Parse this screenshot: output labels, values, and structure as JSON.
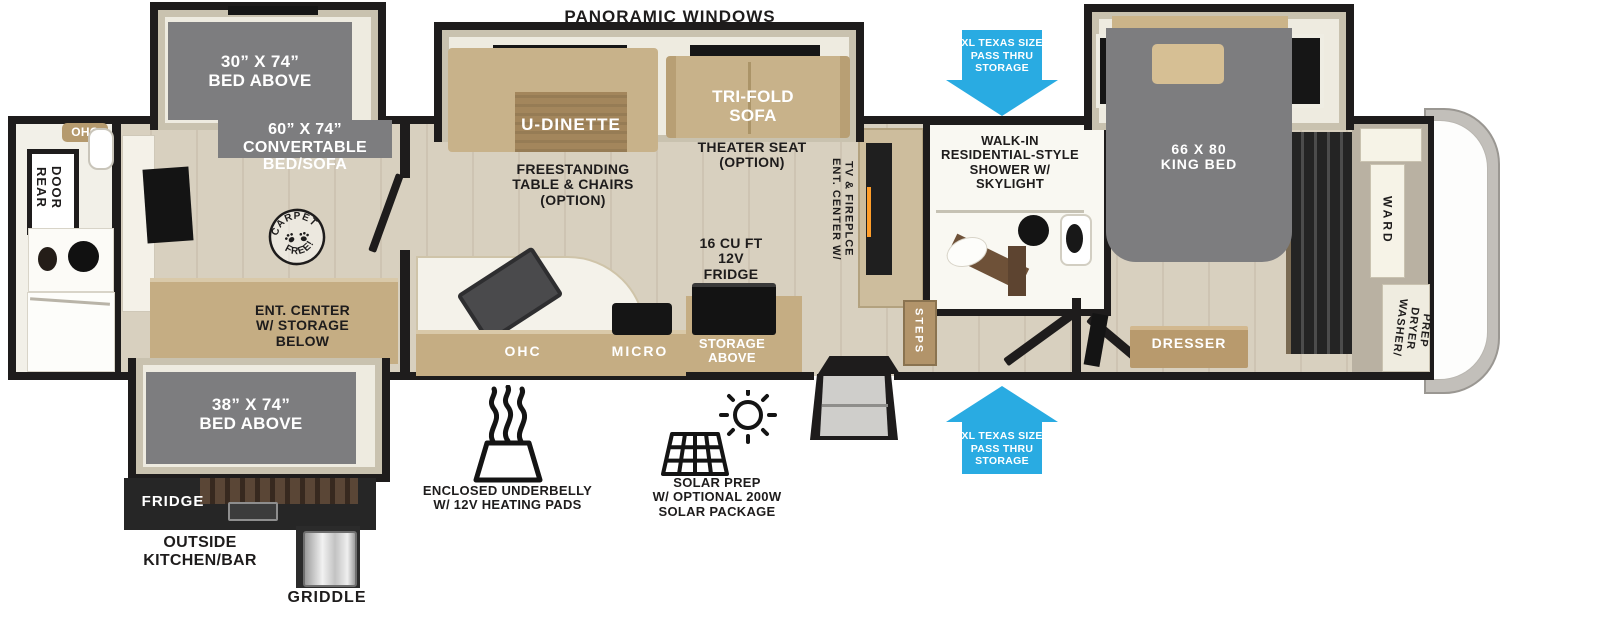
{
  "plan": {
    "type": "rv-floorplan",
    "colors": {
      "arrow_blue": "#29abe2",
      "bed_gray": "#7d7d7f",
      "wall_black": "#1e1c1c",
      "floor_wood": "#d8d0bf",
      "cabinet_tan": "#c5ad83",
      "slide_beige": "#eeebe0"
    }
  },
  "exterior": {
    "panoramic_windows": "PANORAMIC WINDOWS",
    "pass_thru_top": "XL TEXAS SIZE\nPASS THRU\nSTORAGE",
    "pass_thru_bottom": "XL TEXAS SIZE\nPASS THRU\nSTORAGE",
    "outside_kitchen": "OUTSIDE\nKITCHEN/BAR",
    "outside_fridge": "FRIDGE",
    "griddle": "GRIDDLE",
    "underbelly": "ENCLOSED UNDERBELLY\nW/ 12V HEATING PADS",
    "solar": "SOLAR PREP\nW/ OPTIONAL 200W\nSOLAR PACKAGE"
  },
  "rear_bath": {
    "ohc": "OHC",
    "rear_door": "REAR\nDOOR"
  },
  "bunk_room": {
    "bed_above_top": "30” X 74”\nBED ABOVE",
    "convertible": "60” X 74”\nCONVERTABLE\nBED/SOFA",
    "bed_above_bottom": "38” X 74”\nBED ABOVE",
    "ent_center": "ENT. CENTER\nW/ STORAGE\nBELOW",
    "carpet_stamp_top": "CARPET",
    "carpet_stamp_bottom": "FREE!"
  },
  "living": {
    "u_dinette": "U-DINETTE",
    "tri_fold_sofa": "TRI-FOLD\nSOFA",
    "theater_seat": "THEATER SEAT\n(OPTION)",
    "freestanding": "FREESTANDING\nTABLE & CHAIRS\n(OPTION)",
    "fridge": "16 CU FT\n12V\nFRIDGE",
    "ohc": "OHC",
    "micro": "MICRO",
    "storage_above": "STORAGE\nABOVE",
    "ent_center_tv": "ENT. CENTER W/\nTV & FIREPLCE"
  },
  "mid_bath": {
    "shower": "WALK-IN\nRESIDENTIAL-STYLE\nSHOWER W/\nSKYLIGHT",
    "steps": "STEPS"
  },
  "bedroom": {
    "king_bed": "66 X 80\nKING BED",
    "dresser": "DRESSER",
    "ward": "WARD",
    "washer_dryer": "WASHER/\nDRYER\nPREP"
  }
}
